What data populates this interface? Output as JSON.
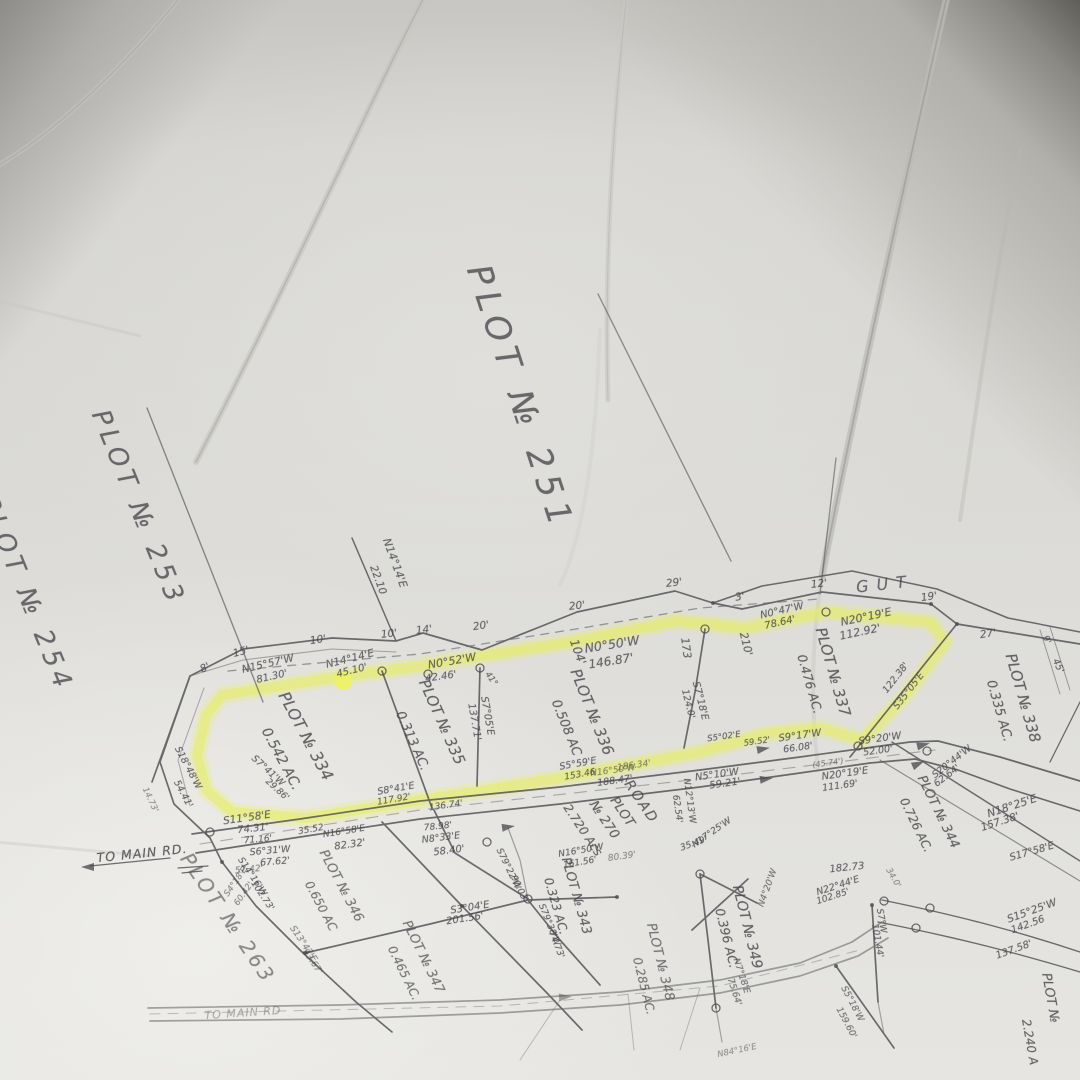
{
  "colors": {
    "paper": "#d9d8d4",
    "ink": "#47474c",
    "highlight": "#e8ee5e",
    "crease": "#b5b4b0"
  },
  "map": {
    "highlighted_parcels": [
      "PLOT № 334",
      "PLOT № 335",
      "PLOT № 336",
      "PLOT № 337"
    ],
    "labels": [
      {
        "t": "PLOT № 251",
        "x": 520,
        "y": 398,
        "r": 72,
        "s": 34,
        "c": "title",
        "ls": 7,
        "n": "plot-251-title"
      },
      {
        "t": "PLOT № 253",
        "x": 138,
        "y": 508,
        "r": 68,
        "s": 26,
        "c": "title",
        "ls": 5,
        "n": "plot-253-title"
      },
      {
        "t": "PLOT № 254",
        "x": 26,
        "y": 594,
        "r": 68,
        "s": 26,
        "c": "title",
        "ls": 5,
        "n": "plot-254-title"
      },
      {
        "t": "PLOT № 263",
        "x": 228,
        "y": 918,
        "r": 56,
        "s": 20,
        "c": "title",
        "ls": 3,
        "o": 0.6,
        "n": "plot-263-title"
      },
      {
        "t": "GUT",
        "x": 885,
        "y": 584,
        "r": -6,
        "s": 16,
        "c": "title",
        "ls": 8,
        "n": "gut-label"
      },
      {
        "t": "PLOT № 334",
        "x": 306,
        "y": 736,
        "r": 62,
        "s": 16,
        "c": "parcel"
      },
      {
        "t": "0.542 AC.",
        "x": 281,
        "y": 759,
        "r": 62,
        "s": 14,
        "c": "parcel"
      },
      {
        "t": "PLOT № 335",
        "x": 442,
        "y": 722,
        "r": 66,
        "s": 15,
        "c": "parcel"
      },
      {
        "t": "0.313 AC.",
        "x": 412,
        "y": 741,
        "r": 66,
        "s": 13,
        "c": "parcel"
      },
      {
        "t": "104'",
        "x": 578,
        "y": 652,
        "r": 70,
        "s": 12,
        "c": "parcel"
      },
      {
        "t": "PLOT № 336",
        "x": 592,
        "y": 712,
        "r": 68,
        "s": 15,
        "c": "parcel"
      },
      {
        "t": "0.508 AC",
        "x": 566,
        "y": 728,
        "r": 68,
        "s": 13,
        "c": "parcel"
      },
      {
        "t": "PLOT № 337",
        "x": 833,
        "y": 672,
        "r": 74,
        "s": 15,
        "c": "parcel"
      },
      {
        "t": "0.476 AC.",
        "x": 810,
        "y": 684,
        "r": 74,
        "s": 12.5,
        "c": "parcel"
      },
      {
        "t": "PLOT № 338",
        "x": 1023,
        "y": 698,
        "r": 74,
        "s": 15,
        "c": "parcel"
      },
      {
        "t": "0.335 AC.",
        "x": 999,
        "y": 711,
        "r": 74,
        "s": 13,
        "c": "parcel"
      },
      {
        "t": "PLOT № 344",
        "x": 938,
        "y": 812,
        "r": 64,
        "s": 13,
        "c": "parcel"
      },
      {
        "t": "0.726 AC.",
        "x": 916,
        "y": 825,
        "r": 64,
        "s": 12,
        "c": "parcel"
      },
      {
        "t": "ROAD",
        "x": 641,
        "y": 802,
        "r": 56,
        "s": 14,
        "c": "parcel",
        "ls": 2
      },
      {
        "t": "PLOT",
        "x": 622,
        "y": 812,
        "r": 56,
        "s": 13,
        "c": "parcel"
      },
      {
        "t": "№ 270",
        "x": 604,
        "y": 820,
        "r": 56,
        "s": 13,
        "c": "parcel"
      },
      {
        "t": "2.720 Acs",
        "x": 583,
        "y": 830,
        "r": 56,
        "s": 12,
        "c": "parcel"
      },
      {
        "t": "PLOT № 343",
        "x": 576,
        "y": 896,
        "r": 74,
        "s": 13,
        "c": "parcel"
      },
      {
        "t": "0.323 AC.",
        "x": 556,
        "y": 906,
        "r": 74,
        "s": 12,
        "c": "parcel"
      },
      {
        "t": "PLOT № 349",
        "x": 747,
        "y": 927,
        "r": 76,
        "s": 14,
        "c": "parcel"
      },
      {
        "t": "0.396 AC.",
        "x": 727,
        "y": 938,
        "r": 76,
        "s": 12.5,
        "c": "parcel"
      },
      {
        "t": "PLOT № 346",
        "x": 341,
        "y": 886,
        "r": 62,
        "s": 13,
        "c": "parcel",
        "o": 0.7
      },
      {
        "t": "0.650 AC",
        "x": 321,
        "y": 906,
        "r": 62,
        "s": 12,
        "c": "parcel",
        "o": 0.7
      },
      {
        "t": "PLOT № 347",
        "x": 423,
        "y": 957,
        "r": 64,
        "s": 13,
        "c": "parcel",
        "o": 0.7
      },
      {
        "t": "0.465 AC.",
        "x": 404,
        "y": 973,
        "r": 64,
        "s": 12,
        "c": "parcel",
        "o": 0.7
      },
      {
        "t": "PLOT № 348",
        "x": 660,
        "y": 962,
        "r": 76,
        "s": 13,
        "c": "parcel",
        "o": 0.7
      },
      {
        "t": "0.285 AC.",
        "x": 644,
        "y": 986,
        "r": 76,
        "s": 12,
        "c": "parcel",
        "o": 0.7
      },
      {
        "t": "PLOT №",
        "x": 1050,
        "y": 998,
        "r": 80,
        "s": 13,
        "c": "parcel"
      },
      {
        "t": "2.240 A",
        "x": 1030,
        "y": 1042,
        "r": 80,
        "s": 12,
        "c": "parcel"
      },
      {
        "t": "8'",
        "x": 205,
        "y": 668,
        "r": -25,
        "s": 10.5,
        "c": "tick"
      },
      {
        "t": "15'",
        "x": 241,
        "y": 652,
        "r": -15,
        "s": 10.5,
        "c": "tick"
      },
      {
        "t": "10'",
        "x": 318,
        "y": 640,
        "r": -8,
        "s": 10.5,
        "c": "tick"
      },
      {
        "t": "10'",
        "x": 389,
        "y": 634,
        "r": -6,
        "s": 10.5,
        "c": "tick"
      },
      {
        "t": "14'",
        "x": 424,
        "y": 630,
        "r": -6,
        "s": 10.5,
        "c": "tick"
      },
      {
        "t": "20'",
        "x": 481,
        "y": 626,
        "r": -8,
        "s": 10.5,
        "c": "tick"
      },
      {
        "t": "20'",
        "x": 577,
        "y": 606,
        "r": -6,
        "s": 10.5,
        "c": "tick"
      },
      {
        "t": "29'",
        "x": 674,
        "y": 583,
        "r": -6,
        "s": 10.5,
        "c": "tick"
      },
      {
        "t": "3'",
        "x": 740,
        "y": 597,
        "r": -10,
        "s": 10.5,
        "c": "tick"
      },
      {
        "t": "12'",
        "x": 819,
        "y": 584,
        "r": -6,
        "s": 10.5,
        "c": "tick"
      },
      {
        "t": "19'",
        "x": 929,
        "y": 597,
        "r": -8,
        "s": 10.5,
        "c": "tick"
      },
      {
        "t": "27'",
        "x": 988,
        "y": 634,
        "r": -8,
        "s": 10.5,
        "c": "tick"
      },
      {
        "t": "9'",
        "x": 1046,
        "y": 640,
        "r": 65,
        "s": 9,
        "c": "tick"
      },
      {
        "t": "45'",
        "x": 1058,
        "y": 666,
        "r": 65,
        "s": 9.5,
        "c": "tick"
      },
      {
        "t": "N14°14'E",
        "x": 395,
        "y": 563,
        "r": 70,
        "s": 11
      },
      {
        "t": "22.10",
        "x": 378,
        "y": 580,
        "r": 70,
        "s": 10.5
      },
      {
        "t": "N15°57'W",
        "x": 268,
        "y": 664,
        "r": -13,
        "s": 10.5
      },
      {
        "t": "81.30'",
        "x": 272,
        "y": 677,
        "r": -13,
        "s": 10
      },
      {
        "t": "N14°14'E",
        "x": 350,
        "y": 659,
        "r": -14,
        "s": 10.5
      },
      {
        "t": "45.10'",
        "x": 352,
        "y": 671,
        "r": -14,
        "s": 10
      },
      {
        "t": "N0°52'W",
        "x": 452,
        "y": 661,
        "r": -10,
        "s": 11
      },
      {
        "t": "42.46'",
        "x": 441,
        "y": 677,
        "r": -8,
        "s": 10
      },
      {
        "t": "41°",
        "x": 491,
        "y": 679,
        "r": 55,
        "s": 8.5
      },
      {
        "t": "S7°05'E",
        "x": 487,
        "y": 716,
        "r": 80,
        "s": 10
      },
      {
        "t": "137.71'",
        "x": 474,
        "y": 722,
        "r": 80,
        "s": 10
      },
      {
        "t": "N0°50'W",
        "x": 612,
        "y": 644,
        "r": -9,
        "s": 12.5
      },
      {
        "t": "146.87'",
        "x": 611,
        "y": 661,
        "r": -9,
        "s": 12
      },
      {
        "t": "173",
        "x": 686,
        "y": 648,
        "r": 82,
        "s": 11
      },
      {
        "t": "210'",
        "x": 746,
        "y": 644,
        "r": 76,
        "s": 11
      },
      {
        "t": "S7°18'E",
        "x": 700,
        "y": 701,
        "r": 76,
        "s": 10
      },
      {
        "t": "124.0'",
        "x": 688,
        "y": 704,
        "r": 76,
        "s": 9.5
      },
      {
        "t": "N0°47'W",
        "x": 782,
        "y": 611,
        "r": -13,
        "s": 10
      },
      {
        "t": "78.64'",
        "x": 780,
        "y": 623,
        "r": -13,
        "s": 10
      },
      {
        "t": "N20°19'E",
        "x": 866,
        "y": 617,
        "r": -12,
        "s": 11
      },
      {
        "t": "112.92'",
        "x": 860,
        "y": 632,
        "r": -12,
        "s": 11
      },
      {
        "t": "S35°05'E",
        "x": 909,
        "y": 691,
        "r": -52,
        "s": 9.5
      },
      {
        "t": "122.38'",
        "x": 896,
        "y": 678,
        "r": -52,
        "s": 9.5
      },
      {
        "t": "S5°02'E",
        "x": 724,
        "y": 737,
        "r": -8,
        "s": 8.5
      },
      {
        "t": "59.52'",
        "x": 757,
        "y": 742,
        "r": -8,
        "s": 8.5
      },
      {
        "t": "S9°17'W",
        "x": 800,
        "y": 736,
        "r": -8,
        "s": 10
      },
      {
        "t": "66.08'",
        "x": 798,
        "y": 748,
        "r": -8,
        "s": 9.5
      },
      {
        "t": "S9°20'W",
        "x": 880,
        "y": 739,
        "r": -8,
        "s": 10
      },
      {
        "t": "52.00'",
        "x": 878,
        "y": 751,
        "r": -8,
        "s": 9.5
      },
      {
        "t": "S20°44'W",
        "x": 952,
        "y": 762,
        "r": -38,
        "s": 9.5
      },
      {
        "t": "62.64'",
        "x": 947,
        "y": 776,
        "r": -38,
        "s": 9.5
      },
      {
        "t": "(45.74')",
        "x": 828,
        "y": 763,
        "r": -8,
        "s": 8,
        "o": 0.6
      },
      {
        "t": "N20°19'E",
        "x": 845,
        "y": 774,
        "r": -8,
        "s": 10
      },
      {
        "t": "111.69'",
        "x": 840,
        "y": 786,
        "r": -8,
        "s": 9.5
      },
      {
        "t": "N18°25'E",
        "x": 1012,
        "y": 806,
        "r": -18,
        "s": 11
      },
      {
        "t": "157.38'",
        "x": 1000,
        "y": 822,
        "r": -18,
        "s": 10.5
      },
      {
        "t": "S17°58'E",
        "x": 1032,
        "y": 852,
        "r": -16,
        "s": 10
      },
      {
        "t": "182.73",
        "x": 847,
        "y": 868,
        "r": -6,
        "s": 10
      },
      {
        "t": "N22°44'E",
        "x": 838,
        "y": 886,
        "r": -18,
        "s": 9.5
      },
      {
        "t": "102.85'",
        "x": 833,
        "y": 897,
        "r": -18,
        "s": 9
      },
      {
        "t": "S7°W",
        "x": 881,
        "y": 921,
        "r": 80,
        "s": 9
      },
      {
        "t": "101.44'",
        "x": 877,
        "y": 941,
        "r": 80,
        "s": 9
      },
      {
        "t": "S15°25'W",
        "x": 1032,
        "y": 911,
        "r": -20,
        "s": 10.5
      },
      {
        "t": "142.56",
        "x": 1028,
        "y": 925,
        "r": -20,
        "s": 10
      },
      {
        "t": "137.58'",
        "x": 1014,
        "y": 950,
        "r": -20,
        "s": 10
      },
      {
        "t": "34.0'",
        "x": 893,
        "y": 878,
        "r": 60,
        "s": 8.5,
        "o": 0.55
      },
      {
        "t": "S18°48'W",
        "x": 188,
        "y": 768,
        "r": 62,
        "s": 9.5
      },
      {
        "t": "54.41'",
        "x": 183,
        "y": 794,
        "r": 62,
        "s": 9.5
      },
      {
        "t": "14.73'",
        "x": 150,
        "y": 800,
        "r": 65,
        "s": 8.5,
        "o": 0.55
      },
      {
        "t": "S7°41'W",
        "x": 268,
        "y": 771,
        "r": 42,
        "s": 9.5
      },
      {
        "t": "29.86'",
        "x": 277,
        "y": 790,
        "r": 42,
        "s": 9
      },
      {
        "t": "S11°58'E",
        "x": 247,
        "y": 818,
        "r": -8,
        "s": 10.5
      },
      {
        "t": "74.31'",
        "x": 253,
        "y": 829,
        "r": -6,
        "s": 10
      },
      {
        "t": "71.16'",
        "x": 258,
        "y": 840,
        "r": -5,
        "s": 9
      },
      {
        "t": "S6°31'W",
        "x": 270,
        "y": 851,
        "r": -5,
        "s": 9.5
      },
      {
        "t": "67.62'",
        "x": 275,
        "y": 862,
        "r": -5,
        "s": 9.5
      },
      {
        "t": "57.42'",
        "x": 249,
        "y": 870,
        "r": -5,
        "s": 9,
        "o": 0.6
      },
      {
        "t": "S4°18'E",
        "x": 236,
        "y": 882,
        "r": -55,
        "s": 8.5,
        "o": 0.6
      },
      {
        "t": "60.42'",
        "x": 244,
        "y": 894,
        "r": -55,
        "s": 8.5,
        "o": 0.6
      },
      {
        "t": "35.52",
        "x": 311,
        "y": 830,
        "r": -10,
        "s": 9
      },
      {
        "t": "N16°58'E",
        "x": 344,
        "y": 832,
        "r": -9,
        "s": 9
      },
      {
        "t": "82.32'",
        "x": 350,
        "y": 845,
        "r": -8,
        "s": 10
      },
      {
        "t": "78.98'",
        "x": 438,
        "y": 827,
        "r": -6,
        "s": 9
      },
      {
        "t": "N8°33'E",
        "x": 441,
        "y": 838,
        "r": -7,
        "s": 9.5
      },
      {
        "t": "58.40'",
        "x": 449,
        "y": 851,
        "r": -7,
        "s": 10
      },
      {
        "t": "S8°41'E",
        "x": 396,
        "y": 789,
        "r": -10,
        "s": 9.5
      },
      {
        "t": "117.92'",
        "x": 394,
        "y": 800,
        "r": -10,
        "s": 9
      },
      {
        "t": "136.74'",
        "x": 446,
        "y": 806,
        "r": -8,
        "s": 9
      },
      {
        "t": "S5°59'E",
        "x": 578,
        "y": 764,
        "r": -10,
        "s": 9.5
      },
      {
        "t": "153.46",
        "x": 580,
        "y": 775,
        "r": -10,
        "s": 9
      },
      {
        "t": "188.47'",
        "x": 615,
        "y": 781,
        "r": -8,
        "s": 9.5
      },
      {
        "t": "N16°50'W",
        "x": 613,
        "y": 771,
        "r": -8,
        "s": 9,
        "o": 0.6
      },
      {
        "t": "186.34'",
        "x": 634,
        "y": 766,
        "r": -8,
        "s": 9,
        "o": 0.6
      },
      {
        "t": "N5°10'W",
        "x": 717,
        "y": 775,
        "r": -8,
        "s": 10
      },
      {
        "t": "59.21'",
        "x": 725,
        "y": 784,
        "r": -8,
        "s": 10
      },
      {
        "t": "N12°13'W",
        "x": 689,
        "y": 801,
        "r": 82,
        "s": 9
      },
      {
        "t": "62.54'",
        "x": 677,
        "y": 809,
        "r": 82,
        "s": 9
      },
      {
        "t": "N17°25'W",
        "x": 712,
        "y": 833,
        "r": -35,
        "s": 9
      },
      {
        "t": "35.49'",
        "x": 694,
        "y": 844,
        "r": -20,
        "s": 9
      },
      {
        "t": "S79°22'W",
        "x": 508,
        "y": 869,
        "r": 64,
        "s": 9
      },
      {
        "t": "90.03'",
        "x": 519,
        "y": 889,
        "r": 64,
        "s": 9
      },
      {
        "t": "S3°04'E",
        "x": 470,
        "y": 908,
        "r": -9,
        "s": 10
      },
      {
        "t": "201.56'",
        "x": 465,
        "y": 919,
        "r": -9,
        "s": 10
      },
      {
        "t": "S79°38'W",
        "x": 549,
        "y": 925,
        "r": 68,
        "s": 9
      },
      {
        "t": "74.73'",
        "x": 556,
        "y": 945,
        "r": 68,
        "s": 9
      },
      {
        "t": "N16°50'W",
        "x": 581,
        "y": 851,
        "r": -10,
        "s": 9
      },
      {
        "t": "161.56'",
        "x": 580,
        "y": 863,
        "r": -10,
        "s": 9
      },
      {
        "t": "80.39'",
        "x": 622,
        "y": 857,
        "r": -8,
        "s": 9,
        "o": 0.55
      },
      {
        "t": "S14°16'W",
        "x": 252,
        "y": 877,
        "r": 56,
        "s": 9
      },
      {
        "t": "102.73'",
        "x": 262,
        "y": 896,
        "r": 56,
        "s": 9
      },
      {
        "t": "S13°42'E",
        "x": 303,
        "y": 944,
        "r": 56,
        "s": 9,
        "o": 0.6
      },
      {
        "t": "93.67'",
        "x": 312,
        "y": 962,
        "r": 56,
        "s": 9,
        "o": 0.6
      },
      {
        "t": "N4°20'W",
        "x": 768,
        "y": 888,
        "r": -70,
        "s": 9,
        "o": 0.7
      },
      {
        "t": "N7°18'E",
        "x": 741,
        "y": 976,
        "r": 72,
        "s": 9,
        "o": 0.7
      },
      {
        "t": "75.64'",
        "x": 734,
        "y": 992,
        "r": 72,
        "s": 9,
        "o": 0.7
      },
      {
        "t": "S5°18'W",
        "x": 852,
        "y": 1004,
        "r": 62,
        "s": 9,
        "o": 0.7
      },
      {
        "t": "159.60'",
        "x": 846,
        "y": 1023,
        "r": 62,
        "s": 9,
        "o": 0.7
      },
      {
        "t": "N84°16'E",
        "x": 737,
        "y": 1051,
        "r": -12,
        "s": 8.5,
        "o": 0.5
      },
      {
        "t": "TO MAIN RD.",
        "x": 142,
        "y": 853,
        "r": -6,
        "s": 12.5,
        "c": "road-label",
        "n": "to-main-rd-label"
      },
      {
        "t": "TO MAIN RD",
        "x": 243,
        "y": 1013,
        "r": -4,
        "s": 11,
        "c": "road-label",
        "o": 0.4,
        "n": "to-main-rd-label-2"
      }
    ]
  }
}
